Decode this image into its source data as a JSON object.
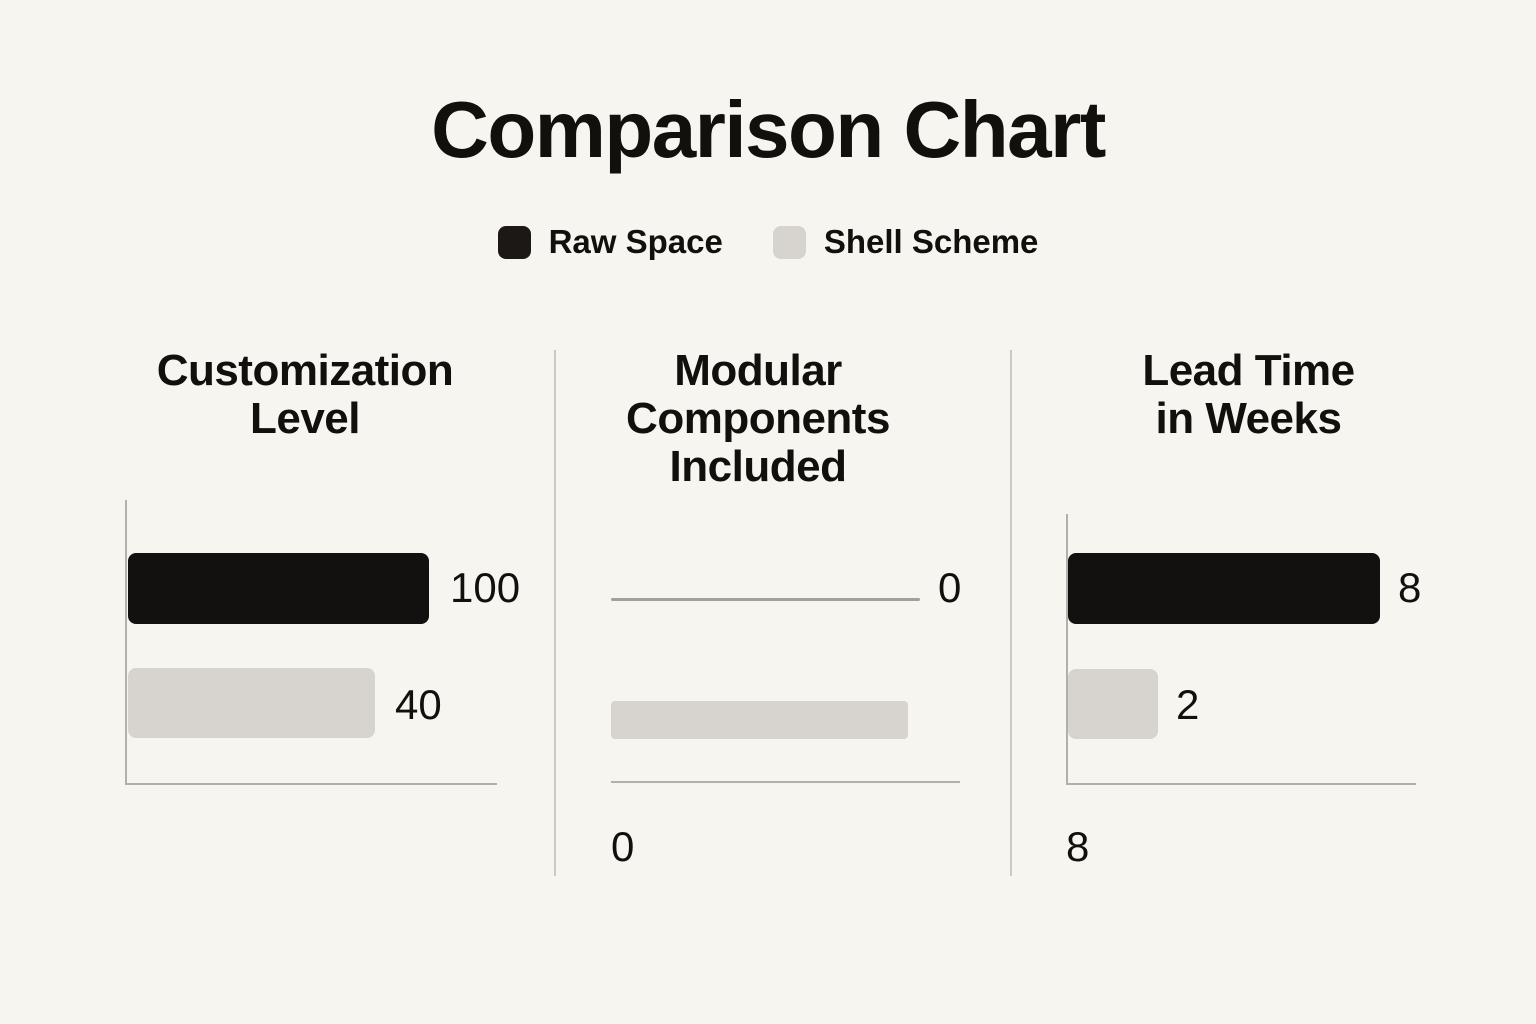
{
  "page": {
    "title": "Comparison Chart",
    "background": "#f7f5f0",
    "text_color": "#12100c"
  },
  "legend": {
    "items": [
      {
        "label": "Raw Space",
        "color": "#1b1815"
      },
      {
        "label": "Shell Scheme",
        "color": "#d7d4d0"
      }
    ]
  },
  "chart_data": {
    "type": "bar",
    "orientation": "horizontal",
    "title": "Comparison Chart",
    "series": [
      "Raw Space",
      "Shell Scheme"
    ],
    "colors": {
      "raw_space": "#131110",
      "shell_scheme": "#d7d4d0",
      "axis_line": "#b3b0ab",
      "zero_line": "#a39f9a",
      "divider": "#ccc9c4"
    },
    "legend_position": "top-center",
    "grid": false,
    "note": "Bar lengths as drawn are not linearly proportional to values",
    "panels": [
      {
        "title": "Customization Level",
        "title_lines": [
          "Customization",
          "Level"
        ],
        "bars": [
          {
            "series": "Raw Space",
            "value": 100,
            "label": "100"
          },
          {
            "series": "Shell Scheme",
            "value": 40,
            "label": "40"
          }
        ],
        "bottom_label": ""
      },
      {
        "title": "Modular Components Included",
        "title_lines": [
          "Modular",
          "Components",
          "Included"
        ],
        "bars": [
          {
            "series": "Raw Space",
            "value": 0,
            "label": "0"
          },
          {
            "series": "Shell Scheme",
            "value": null,
            "label": ""
          }
        ],
        "bottom_label": "0"
      },
      {
        "title": "Lead Time in Weeks",
        "title_lines": [
          "Lead Time",
          "in Weeks"
        ],
        "bars": [
          {
            "series": "Raw Space",
            "value": 8,
            "label": "8"
          },
          {
            "series": "Shell Scheme",
            "value": 2,
            "label": "2"
          }
        ],
        "bottom_label": "8"
      }
    ],
    "layout": {
      "canvas": {
        "width": 1536,
        "height": 1024
      },
      "dividers": [
        {
          "left": 554,
          "top": 350,
          "width": 2,
          "height": 526
        },
        {
          "left": 1010,
          "top": 350,
          "width": 2,
          "height": 526
        }
      ],
      "panels": [
        {
          "title": {
            "left": 100,
            "top": 347,
            "width": 410
          },
          "axis_v": {
            "left": 125,
            "top": 500,
            "width": 2,
            "height": 284
          },
          "axis_h": {
            "left": 125,
            "top": 783,
            "width": 372,
            "height": 2
          },
          "bars": [
            {
              "left": 128,
              "top": 553,
              "width": 301,
              "height": 71
            },
            {
              "left": 128,
              "top": 668,
              "width": 247,
              "height": 70
            }
          ],
          "labels": [
            {
              "left": 450,
              "top": 567
            },
            {
              "left": 395,
              "top": 684
            }
          ]
        },
        {
          "title": {
            "left": 558,
            "top": 347,
            "width": 400
          },
          "axis_h": {
            "left": 611,
            "top": 781,
            "width": 349,
            "height": 2
          },
          "bars": [
            {
              "left": 611,
              "top": 598,
              "width": 309,
              "height": 3
            },
            {
              "left": 611,
              "top": 701,
              "width": 297,
              "height": 38
            }
          ],
          "labels": [
            {
              "left": 938,
              "top": 567
            }
          ],
          "bottom_label": {
            "left": 611,
            "top": 826
          }
        },
        {
          "title": {
            "left": 1040,
            "top": 347,
            "width": 417
          },
          "axis_v": {
            "left": 1066,
            "top": 514,
            "width": 2,
            "height": 270
          },
          "axis_h": {
            "left": 1066,
            "top": 783,
            "width": 350,
            "height": 2
          },
          "bars": [
            {
              "left": 1068,
              "top": 553,
              "width": 312,
              "height": 71
            },
            {
              "left": 1068,
              "top": 669,
              "width": 90,
              "height": 70
            }
          ],
          "labels": [
            {
              "left": 1398,
              "top": 567
            },
            {
              "left": 1176,
              "top": 684
            }
          ],
          "bottom_label": {
            "left": 1066,
            "top": 826
          }
        }
      ]
    }
  }
}
